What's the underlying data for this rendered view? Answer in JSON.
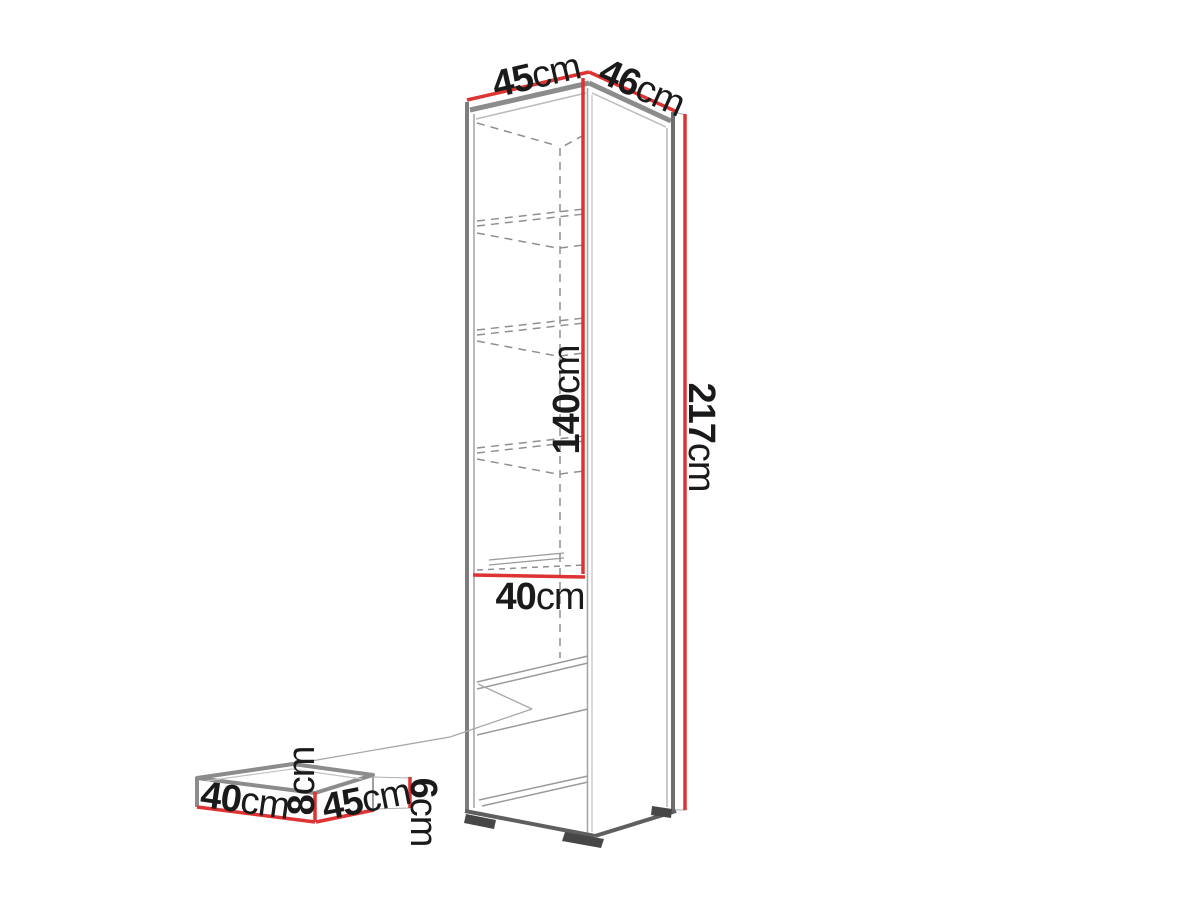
{
  "diagram": {
    "description": "Tall cabinet dimension diagram with drawer detail",
    "dimensions": {
      "top_width": {
        "value": "45",
        "unit": "cm"
      },
      "top_depth": {
        "value": "46",
        "unit": "cm"
      },
      "inner_height": {
        "value": "140",
        "unit": "cm"
      },
      "total_height": {
        "value": "217",
        "unit": "cm"
      },
      "inner_width": {
        "value": "40",
        "unit": "cm"
      },
      "detail_depth": {
        "value": "40",
        "unit": "cm"
      },
      "detail_height": {
        "value": "8",
        "unit": "cm"
      },
      "detail_width": {
        "value": "45",
        "unit": "cm"
      },
      "detail_front_height": {
        "value": "6",
        "unit": "cm"
      }
    },
    "colors": {
      "dimension_red": "#dd3333",
      "outline_gray": "#8c8c8c",
      "outline_dark": "#5f5f5f",
      "dashed_gray": "#8f8f8f",
      "text": "#1a1a1a",
      "background": "#ffffff"
    }
  }
}
